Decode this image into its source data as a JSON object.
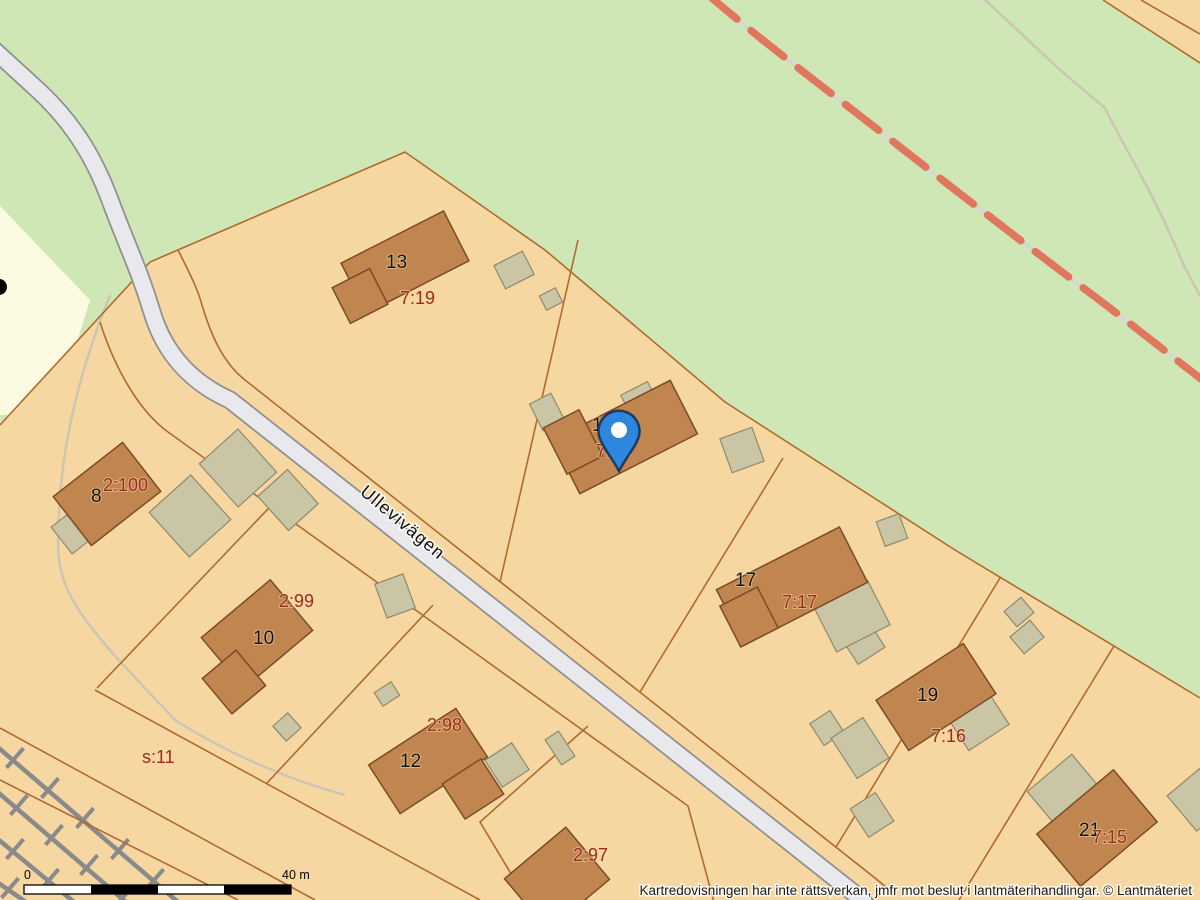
{
  "map": {
    "street": {
      "name": "Ullevivägen"
    },
    "marker": {
      "name": "location-pin",
      "color": "#2e86de"
    },
    "houses": [
      {
        "number": "13",
        "parcel": "7:19"
      },
      {
        "number": "15",
        "parcel": "7:18"
      },
      {
        "number": "8",
        "parcel": "2:100"
      },
      {
        "number": "10",
        "parcel": "2:99"
      },
      {
        "number": "12",
        "parcel": "2:98"
      },
      {
        "number": "17",
        "parcel": "7:17"
      },
      {
        "number": "19",
        "parcel": "7:16"
      },
      {
        "number": "21",
        "parcel": "7:15"
      }
    ],
    "other_parcels": [
      {
        "id": "2:97"
      },
      {
        "id": "s:11"
      }
    ],
    "scale_bar": {
      "start": "0",
      "end": "40 m"
    },
    "attribution": "Kartredovisningen har inte rättsverkan, jmfr mot beslut i lantmäterihandlingar. © Lantmäteriet",
    "colors": {
      "forest_green": "#cfe7b5",
      "parcel_orange": "#f6d7a2",
      "field_yellow": "#fcfae1",
      "building_brown": "#c18550",
      "outbuilding_tan": "#cac5a5",
      "boundary_line": "#b06a2d",
      "road_fill": "#e9e9ed",
      "railway_gray": "#8a8a8a",
      "trail_red": "#e0765e",
      "label_red": "#9c2b1f"
    }
  }
}
